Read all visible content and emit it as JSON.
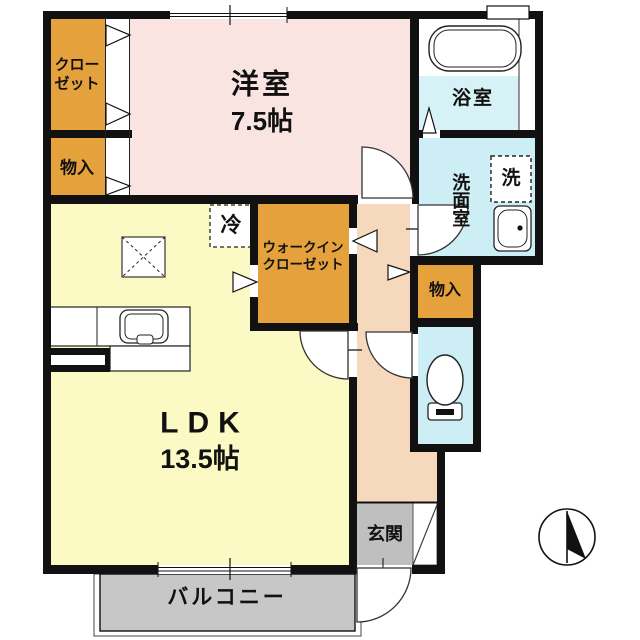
{
  "plan_title": "1LDK apartment floor plan",
  "labels": {
    "western_room_name": "洋室",
    "western_room_size": "7.5帖",
    "closet_line1": "クロー",
    "closet_line2": "ゼット",
    "storage_left": "物入",
    "storage_right": "物入",
    "bathroom": "浴室",
    "washroom": "洗面室",
    "washing_machine": "洗",
    "wic_line1": "ウォークイン",
    "wic_line2": "クローゼット",
    "refrigerator": "冷",
    "ldk_name": "LDK",
    "ldk_size": "13.5帖",
    "entrance": "玄関",
    "balcony": "バルコニー"
  },
  "colors": {
    "wall": "#111111",
    "western_room": "#f9e4e2",
    "ldk": "#fbf9c4",
    "closet_orange": "#e5a23c",
    "wet_cyan": "#cdeef5",
    "bath_cyan": "#d6f2f7",
    "hallway": "#f6d9bd",
    "entrance_gray": "#bfbfbf",
    "balcony_gray": "#c7c7c7",
    "white": "#ffffff"
  }
}
